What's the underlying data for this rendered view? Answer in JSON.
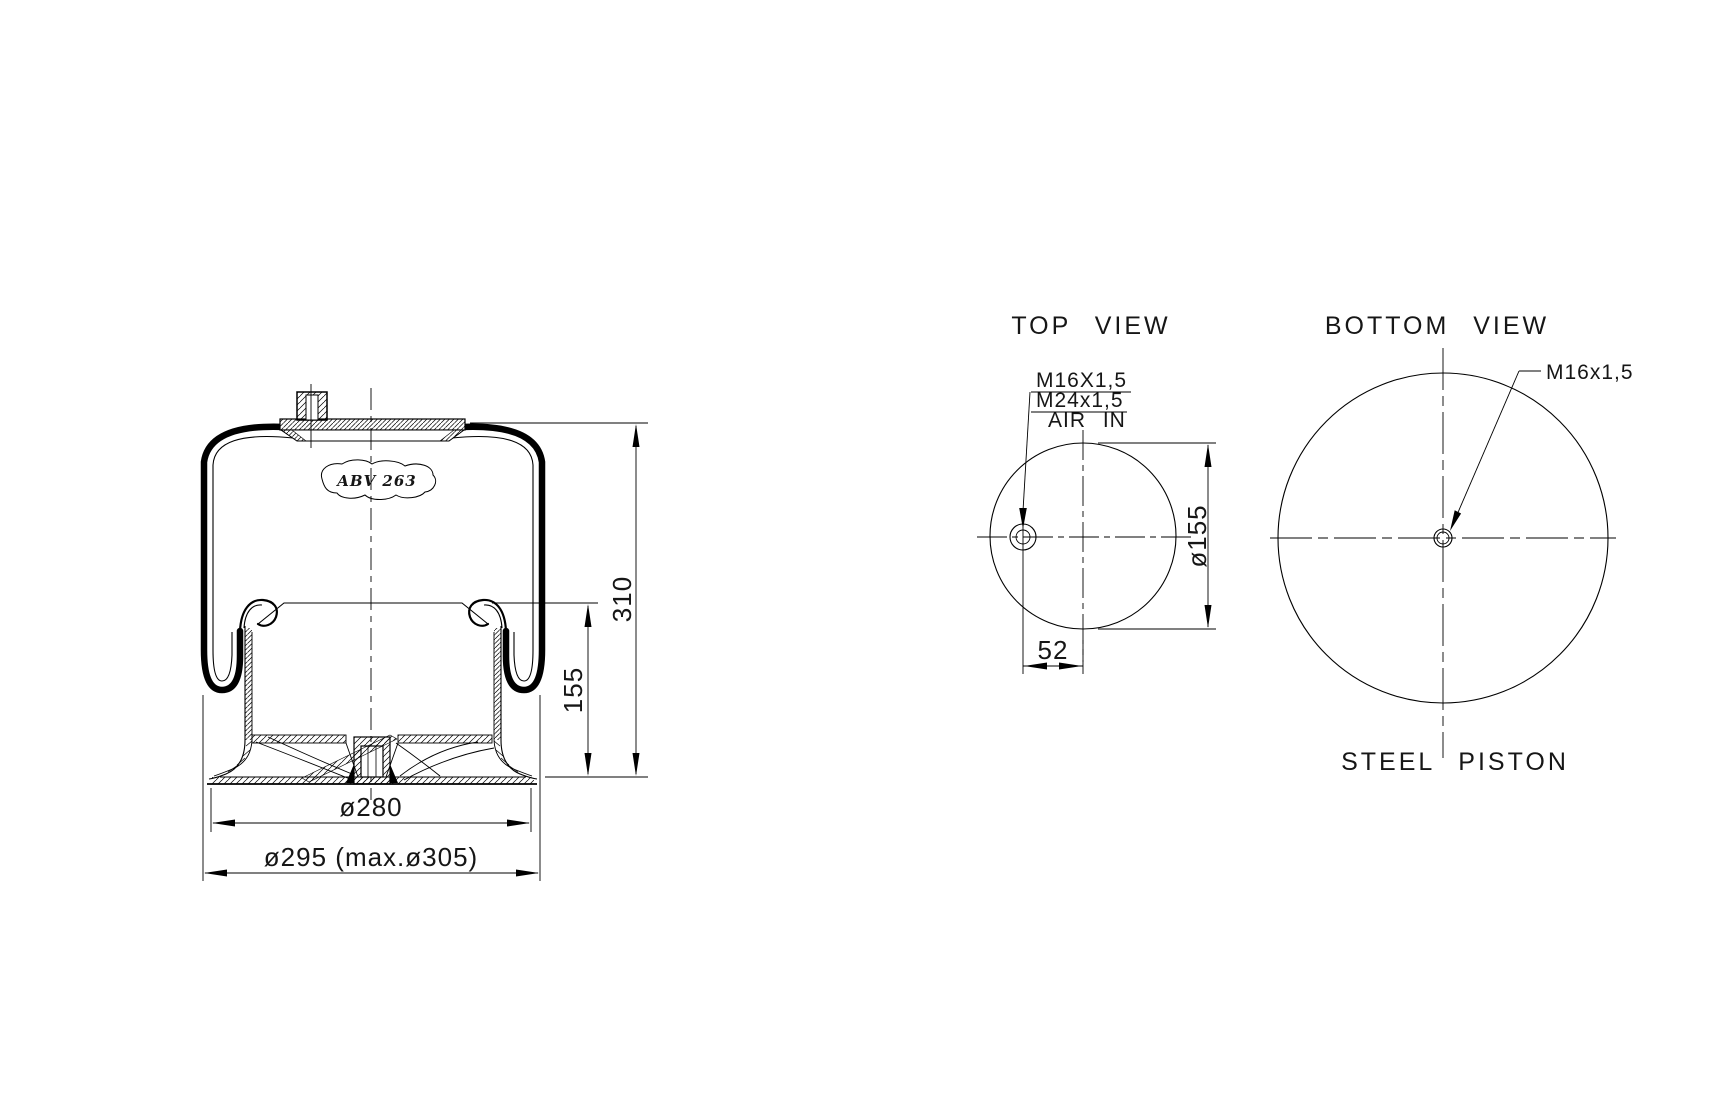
{
  "drawing": {
    "part_label": "ABV 263",
    "side_view": {
      "dim_total_height": "310",
      "dim_piston_height": "155",
      "dim_piston_diameter": "ø280",
      "dim_max_diameter": "ø295 (max.ø305)"
    },
    "top_view": {
      "title": "TOP VIEW",
      "thread_label_1": "M16X1,5",
      "thread_label_2": "M24x1,5",
      "air_label": "AIR IN",
      "dim_offset": "52",
      "dim_diameter": "ø155"
    },
    "bottom_view": {
      "title": "BOTTOM VIEW",
      "thread_label": "M16x1,5",
      "caption": "STEEL PISTON"
    },
    "colors": {
      "line": "#000000",
      "background": "#ffffff"
    }
  }
}
